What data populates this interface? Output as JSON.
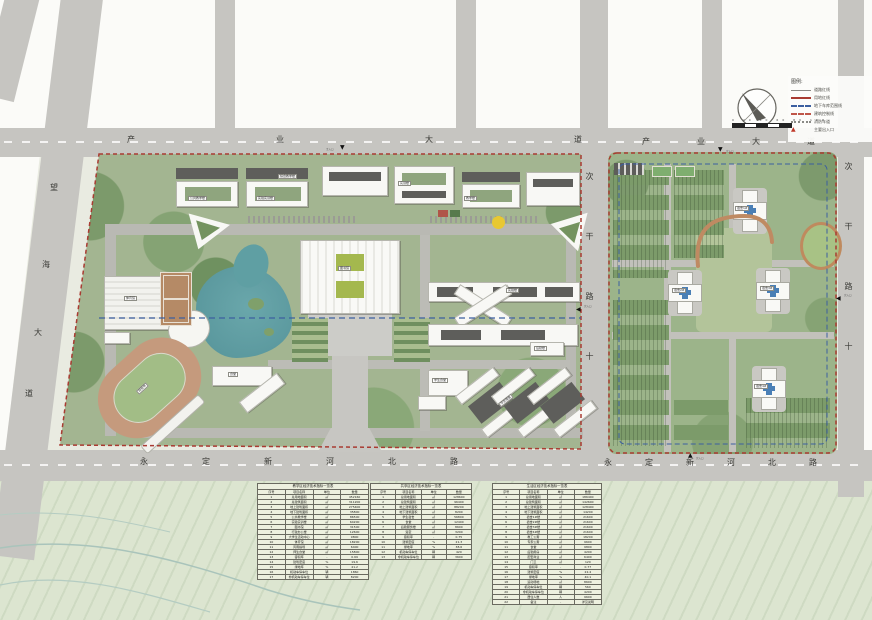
{
  "plan": {
    "type": "campus-master-plan",
    "colors": {
      "boundary_red": "#a93b32",
      "control_blue": "#3c5fa0",
      "lake_teal": "#5f9fa3",
      "track_tan": "#c59a7d",
      "field_green": "#a2bd86",
      "road_gray": "#c6c5c1",
      "campus_green": "#a3b591"
    }
  },
  "roads": {
    "top_left": "产业大道",
    "top_right": "产业大道",
    "bottom_left": "永定新河北路",
    "bottom_right": "永定新河北路",
    "west_chars": [
      "望",
      "海",
      "大",
      "道"
    ],
    "middle_vertical": "次干路十",
    "east_vertical": "次干路十"
  },
  "entrances": {
    "main": "主入口",
    "secondary": "次入口"
  },
  "legend": {
    "title": "图例:",
    "items": [
      {
        "label": "道路红线"
      },
      {
        "label": "用地红线"
      },
      {
        "label": "地下车库范围线"
      },
      {
        "label": "建筑控制线"
      },
      {
        "label": "消防车道"
      },
      {
        "label": "主要出入口"
      }
    ]
  },
  "scalebar": {
    "ticks": "0  20  40  60  80  100",
    "unit": "m"
  },
  "chips": {
    "t1": "公共教学楼",
    "t2": "实验实训楼",
    "t3": "综合教学楼",
    "t4": "实训楼",
    "t5": "教学楼",
    "t6": "图书馆",
    "t7": "体育馆",
    "t8": "田径场",
    "t9": "食堂",
    "t10": "实验楼",
    "t11": "学生食堂",
    "t12": "后勤楼",
    "t13": "学生宿舍",
    "r1": "宿舍1#",
    "r2": "宿舍2#",
    "r3": "宿舍3#",
    "r4": "宿舍4#"
  },
  "tables": {
    "t1": {
      "title": "教学区经济技术指标一览表",
      "cols": [
        "序号",
        "项目名称",
        "单位",
        "数量"
      ],
      "rows": [
        [
          "1",
          "总用地面积",
          "㎡",
          "452160"
        ],
        [
          "2",
          "总建筑面积",
          "㎡",
          "311200"
        ],
        [
          "3",
          "地上建筑面积",
          "㎡",
          "275400"
        ],
        [
          "4",
          "地下建筑面积",
          "㎡",
          "35800"
        ],
        [
          "5",
          "公共教学楼",
          "㎡",
          "86500"
        ],
        [
          "6",
          "实验实训楼",
          "㎡",
          "64200"
        ],
        [
          "7",
          "图书馆",
          "㎡",
          "31500"
        ],
        [
          "8",
          "行政办公楼",
          "㎡",
          "12600"
        ],
        [
          "9",
          "大学生活动中心",
          "㎡",
          "9800"
        ],
        [
          "10",
          "体育馆",
          "㎡",
          "18200"
        ],
        [
          "11",
          "风雨操场",
          "㎡",
          "6400"
        ],
        [
          "12",
          "师生食堂",
          "㎡",
          "15800"
        ],
        [
          "13",
          "容积率",
          "-",
          "0.69"
        ],
        [
          "14",
          "建筑密度",
          "%",
          "19.6"
        ],
        [
          "15",
          "绿地率",
          "%",
          "41.2"
        ],
        [
          "16",
          "机动车停车位",
          "辆",
          "1860"
        ],
        [
          "17",
          "非机动车停车位",
          "辆",
          "8200"
        ]
      ]
    },
    "t2": {
      "title": "共享区经济技术指标一览表",
      "cols": [
        "序号",
        "项目名称",
        "单位",
        "数量"
      ],
      "rows": [
        [
          "1",
          "总用地面积",
          "㎡",
          "128600"
        ],
        [
          "2",
          "总建筑面积",
          "㎡",
          "96400"
        ],
        [
          "3",
          "地上建筑面积",
          "㎡",
          "88200"
        ],
        [
          "4",
          "地下建筑面积",
          "㎡",
          "8200"
        ],
        [
          "5",
          "学生宿舍",
          "㎡",
          "56800"
        ],
        [
          "6",
          "食堂",
          "㎡",
          "12400"
        ],
        [
          "7",
          "后勤服务楼",
          "㎡",
          "8600"
        ],
        [
          "8",
          "浴室",
          "㎡",
          "3200"
        ],
        [
          "9",
          "容积率",
          "-",
          "0.75"
        ],
        [
          "10",
          "建筑密度",
          "%",
          "21.3"
        ],
        [
          "11",
          "绿地率",
          "%",
          "38.6"
        ],
        [
          "12",
          "机动车停车位",
          "辆",
          "420"
        ],
        [
          "13",
          "非机动车停车位",
          "辆",
          "3600"
        ]
      ]
    },
    "t3": {
      "title": "生活区经济技术指标一览表",
      "cols": [
        "序号",
        "项目名称",
        "单位",
        "数量"
      ],
      "rows": [
        [
          "1",
          "总用地面积",
          "㎡",
          "186400"
        ],
        [
          "2",
          "总建筑面积",
          "㎡",
          "142600"
        ],
        [
          "3",
          "地上建筑面积",
          "㎡",
          "128400"
        ],
        [
          "4",
          "地下建筑面积",
          "㎡",
          "14200"
        ],
        [
          "5",
          "宿舍1#楼",
          "㎡",
          "21600"
        ],
        [
          "6",
          "宿舍2#楼",
          "㎡",
          "21600"
        ],
        [
          "7",
          "宿舍3#楼",
          "㎡",
          "21600"
        ],
        [
          "8",
          "宿舍4#楼",
          "㎡",
          "21600"
        ],
        [
          "9",
          "教工公寓",
          "㎡",
          "18200"
        ],
        [
          "10",
          "专家公寓",
          "㎡",
          "9600"
        ],
        [
          "11",
          "食堂",
          "㎡",
          "9800"
        ],
        [
          "12",
          "后勤用房",
          "㎡",
          "4200"
        ],
        [
          "13",
          "配套商业",
          "㎡",
          "6400"
        ],
        [
          "14",
          "门卫",
          "㎡",
          "120"
        ],
        [
          "15",
          "容积率",
          "-",
          "0.77"
        ],
        [
          "16",
          "建筑密度",
          "%",
          "22.4"
        ],
        [
          "17",
          "绿地率",
          "%",
          "40.1"
        ],
        [
          "18",
          "运动场地",
          "㎡",
          "8600"
        ],
        [
          "19",
          "机动车停车位",
          "辆",
          "560"
        ],
        [
          "20",
          "非机动车停车位",
          "辆",
          "4200"
        ],
        [
          "21",
          "居住人数",
          "人",
          "9600"
        ],
        [
          "22",
          "备注",
          "-",
          "详见说明"
        ]
      ]
    }
  }
}
